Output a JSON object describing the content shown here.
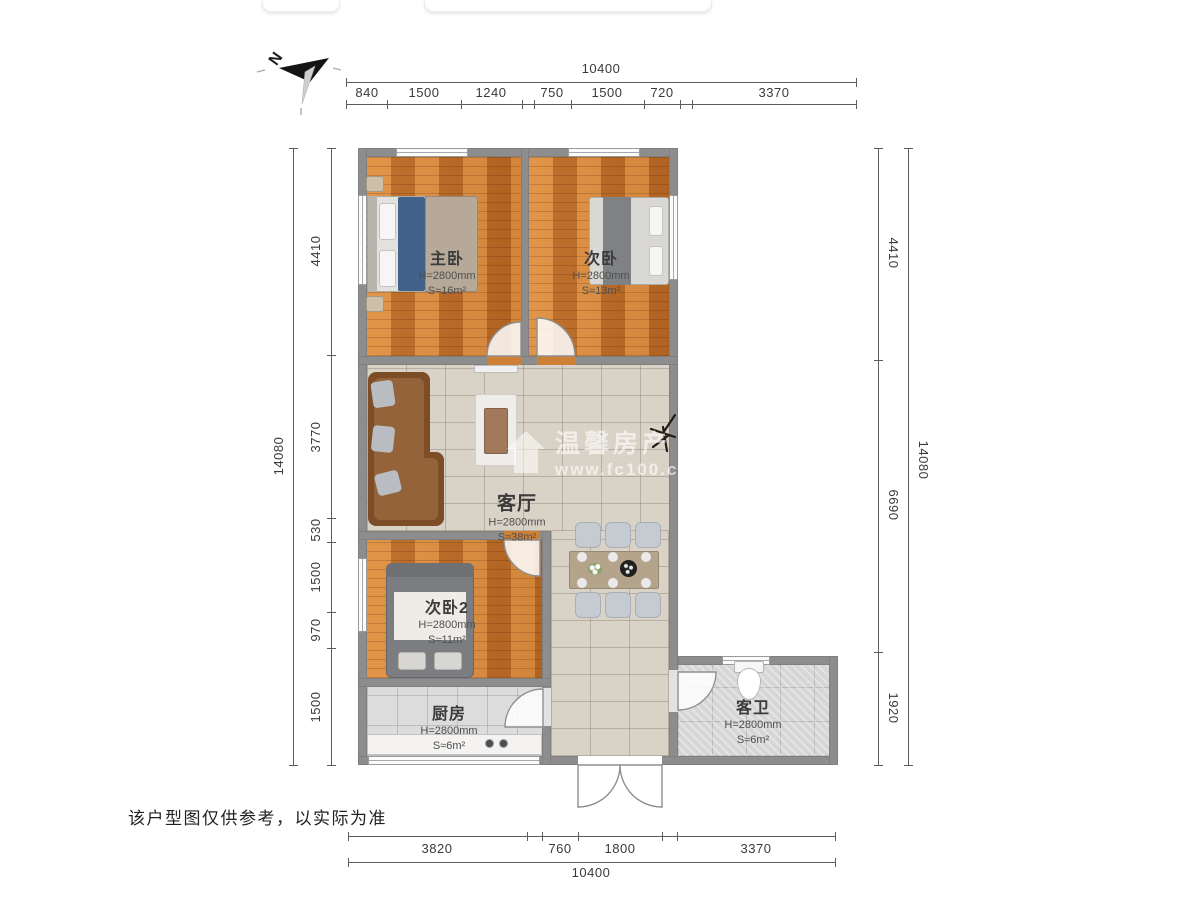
{
  "page": {
    "disclaimer": "该户型图仅供参考，以实际为准"
  },
  "compass": {
    "label": "N"
  },
  "watermark": {
    "brand": "温馨房产",
    "url": "www.fc100.cn"
  },
  "rooms": {
    "master": {
      "name": "主卧",
      "height": "H=2800mm",
      "area": "S≈16m²"
    },
    "second": {
      "name": "次卧",
      "height": "H=2800mm",
      "area": "S≈13m²"
    },
    "living": {
      "name": "客厅",
      "height": "H=2800mm",
      "area": "S≈38m²"
    },
    "second2": {
      "name": "次卧2",
      "height": "H=2800mm",
      "area": "S≈11m²"
    },
    "kitchen": {
      "name": "厨房",
      "height": "H=2800mm",
      "area": "S≈6m²"
    },
    "bathroom": {
      "name": "客卫",
      "height": "H=2800mm",
      "area": "S≈6m²"
    }
  },
  "dimensions": {
    "top": {
      "total": "10400",
      "segments": [
        "840",
        "1500",
        "1240",
        "750",
        "1500",
        "720",
        "3370"
      ]
    },
    "bottom": {
      "total": "10400",
      "segments": [
        "3820",
        "760",
        "1800",
        "3370"
      ]
    },
    "left": {
      "total": "14080",
      "segments": [
        "4410",
        "3770",
        "530",
        "1500",
        "970",
        "1500"
      ]
    },
    "right": {
      "total": "14080",
      "segments": [
        "4410",
        "6690",
        "1920"
      ]
    }
  },
  "colors": {
    "wall": "#8d8d8d",
    "wood_floor": "#c97a2e",
    "living_tile": "#d9d2c6",
    "wet_tile": "#dcdcdc",
    "dim_text": "#3a3a3a"
  }
}
